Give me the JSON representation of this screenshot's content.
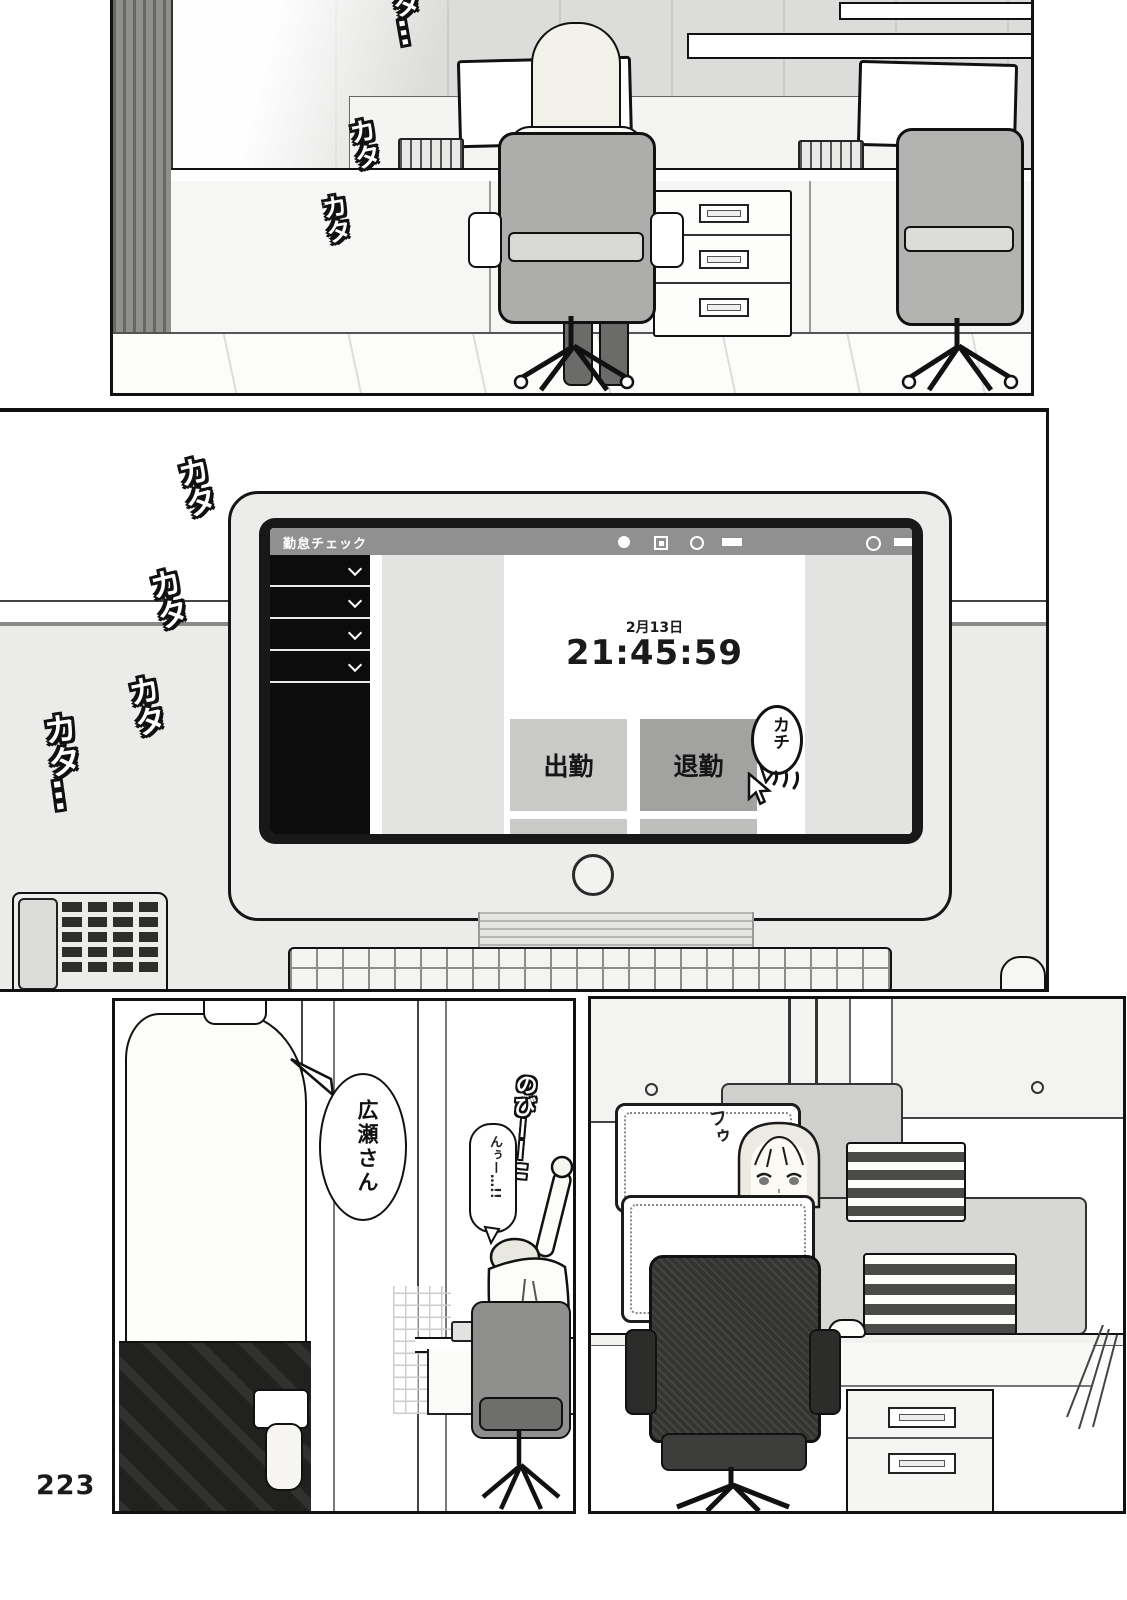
{
  "page": {
    "number": "223"
  },
  "colors": {
    "ink": "#1a1a1a",
    "paper": "#ffffff",
    "titlebar_gray": "#909090",
    "sidebar_black": "#0c0c0c",
    "button_light": "#c9c9c7",
    "button_dark": "#a2a2a0",
    "screen_white": "#ffffff"
  },
  "panels": {
    "top": {
      "sfx": [
        "カタ…",
        "カタ",
        "カタ"
      ]
    },
    "middle": {
      "sfx": [
        "カタ",
        "カタ",
        "カタ",
        "カタ…"
      ],
      "monitor": {
        "app_title": "勤怠チェック",
        "titlebar_icons": [
          "filled-circle-icon",
          "stop-square-icon",
          "ring-icon",
          "bar-icon",
          "ring-icon",
          "long-bar-icon"
        ],
        "date": "2月13日",
        "time": "21:45:59",
        "clock_in_label": "出勤",
        "clock_out_label": "退勤",
        "click_sfx": "カチ"
      }
    },
    "bottom_left": {
      "speech_bubble": "広瀬さん",
      "sfx_stretch": "のびーー!!…",
      "sfx_grunt": "んぅー…!!"
    },
    "bottom_right": {
      "sfx_sigh": "フゥ"
    }
  }
}
